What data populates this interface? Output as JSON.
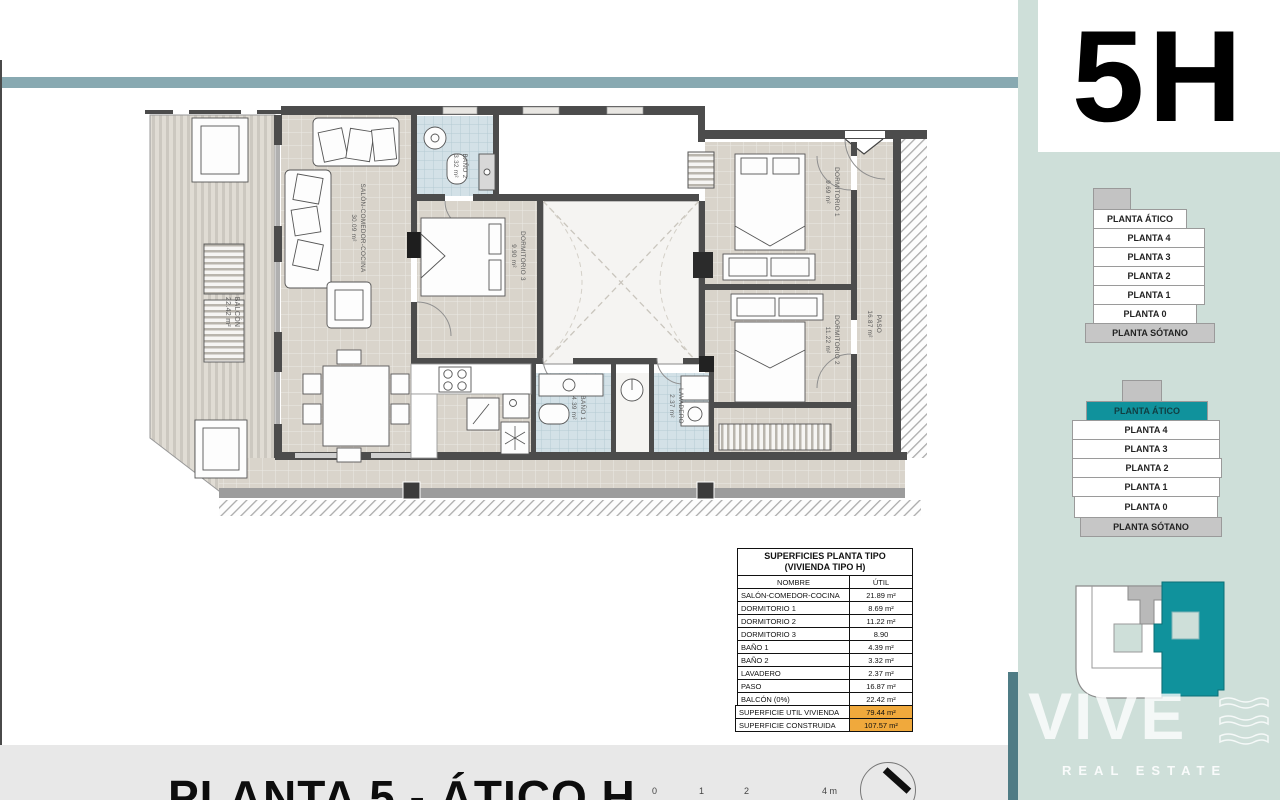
{
  "unit_badge": "5H",
  "footer": {
    "title": "PLANTA 5 - ÁTICO H",
    "scale_ticks": [
      "0",
      "1",
      "2",
      "4 m"
    ]
  },
  "plan": {
    "rooms": {
      "balcon": {
        "name": "BALCÓN",
        "area": "22.42 m²"
      },
      "salon": {
        "name": "SALÓN-COMEDOR-COCINA",
        "area": "30.09 m²"
      },
      "bano2": {
        "name": "BAÑO 2",
        "area": "3.32 m²"
      },
      "dorm3": {
        "name": "DORMITORIO 3",
        "area": "9.90 m²"
      },
      "dorm1": {
        "name": "DORMITORIO 1",
        "area": "9.69 m²"
      },
      "dorm2": {
        "name": "DORMITORIO 2",
        "area": "11.22 m²"
      },
      "paso": {
        "name": "PASO",
        "area": "16.87 m²"
      },
      "bano1": {
        "name": "BAÑO 1",
        "area": "4.39 m²"
      },
      "lavadero": {
        "name": "LAVADERO",
        "area": "2.37 m²"
      }
    }
  },
  "table": {
    "title_line1": "SUPERFICIES PLANTA TIPO",
    "title_line2": "(VIVIENDA TIPO H)",
    "col_name": "NOMBRE",
    "col_util": "ÚTIL",
    "rows": [
      {
        "name": "SALÓN-COMEDOR-COCINA",
        "util": "21.89 m²"
      },
      {
        "name": "DORMITORIO 1",
        "util": "8.69 m²"
      },
      {
        "name": "DORMITORIO 2",
        "util": "11.22 m²"
      },
      {
        "name": "DORMITORIO 3",
        "util": "8.90"
      },
      {
        "name": "BAÑO 1",
        "util": "4.39 m²"
      },
      {
        "name": "BAÑO 2",
        "util": "3.32 m²"
      },
      {
        "name": "LAVADERO",
        "util": "2.37 m²"
      },
      {
        "name": "PASO",
        "util": "16.87 m²"
      },
      {
        "name": "BALCÓN (0%)",
        "util": "22.42 m²"
      }
    ],
    "totals": [
      {
        "label": "SUPERFICIE UTIL VIVIENDA",
        "value": "79.44 m²"
      },
      {
        "label": "SUPERFICIE CONSTRUIDA",
        "value": "107.57 m²"
      }
    ]
  },
  "sidebar": {
    "stack_plain": {
      "floors": [
        "PLANTA ÁTICO",
        "PLANTA 4",
        "PLANTA 3",
        "PLANTA 2",
        "PLANTA 1",
        "PLANTA 0",
        "PLANTA SÓTANO"
      ]
    },
    "stack_highlight": {
      "selected": "PLANTA ÁTICO",
      "floors": [
        "PLANTA ÁTICO",
        "PLANTA 4",
        "PLANTA 3",
        "PLANTA 2",
        "PLANTA 1",
        "PLANTA 0",
        "PLANTA SÓTANO"
      ]
    },
    "watermark": {
      "brand": "VIVE",
      "tagline": "REAL ESTATE"
    }
  },
  "colors": {
    "accent_teal": "#10929c",
    "header_band": "#88a9b1",
    "sidebar_bg": "#cedfd9",
    "highlight_orange": "#f0a93c"
  }
}
